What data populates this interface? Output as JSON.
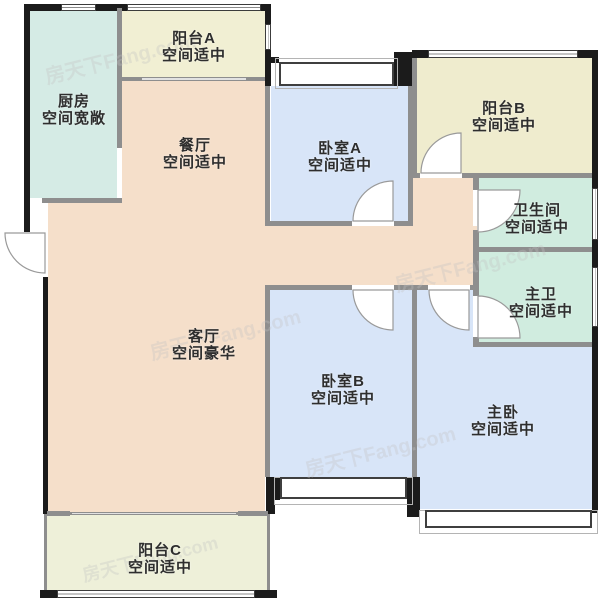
{
  "watermark": {
    "text": "房天下Fang.com"
  },
  "rooms": [
    {
      "id": "kitchen",
      "name": "厨房",
      "desc": "空间宽敞"
    },
    {
      "id": "balcony-a",
      "name": "阳台A",
      "desc": "空间适中"
    },
    {
      "id": "dining",
      "name": "餐厅",
      "desc": "空间适中"
    },
    {
      "id": "bedroom-a",
      "name": "卧室A",
      "desc": "空间适中"
    },
    {
      "id": "balcony-b",
      "name": "阳台B",
      "desc": "空间适中"
    },
    {
      "id": "bathroom",
      "name": "卫生间",
      "desc": "空间适中"
    },
    {
      "id": "master-bath",
      "name": "主卫",
      "desc": "空间适中"
    },
    {
      "id": "living",
      "name": "客厅",
      "desc": "空间豪华"
    },
    {
      "id": "bedroom-b",
      "name": "卧室B",
      "desc": "空间适中"
    },
    {
      "id": "master-bedroom",
      "name": "主卧",
      "desc": "空间适中"
    },
    {
      "id": "balcony-c",
      "name": "阳台C",
      "desc": "空间适中"
    }
  ],
  "colors": {
    "exterior_wall": "#1b1b1b",
    "interior_wall": "#8e8e8e",
    "kitchen_fill": "#d5ebe5",
    "balcony_a_fill": "#f1efd3",
    "balcony_b_fill": "#efecce",
    "balcony_c_fill": "#eef0d9",
    "dining_living_fill": "#f5dfca",
    "bedroom_fill": "#d8e5f8",
    "bath_fill": "#d0ecdf",
    "label_text": "#2e2e2e"
  }
}
